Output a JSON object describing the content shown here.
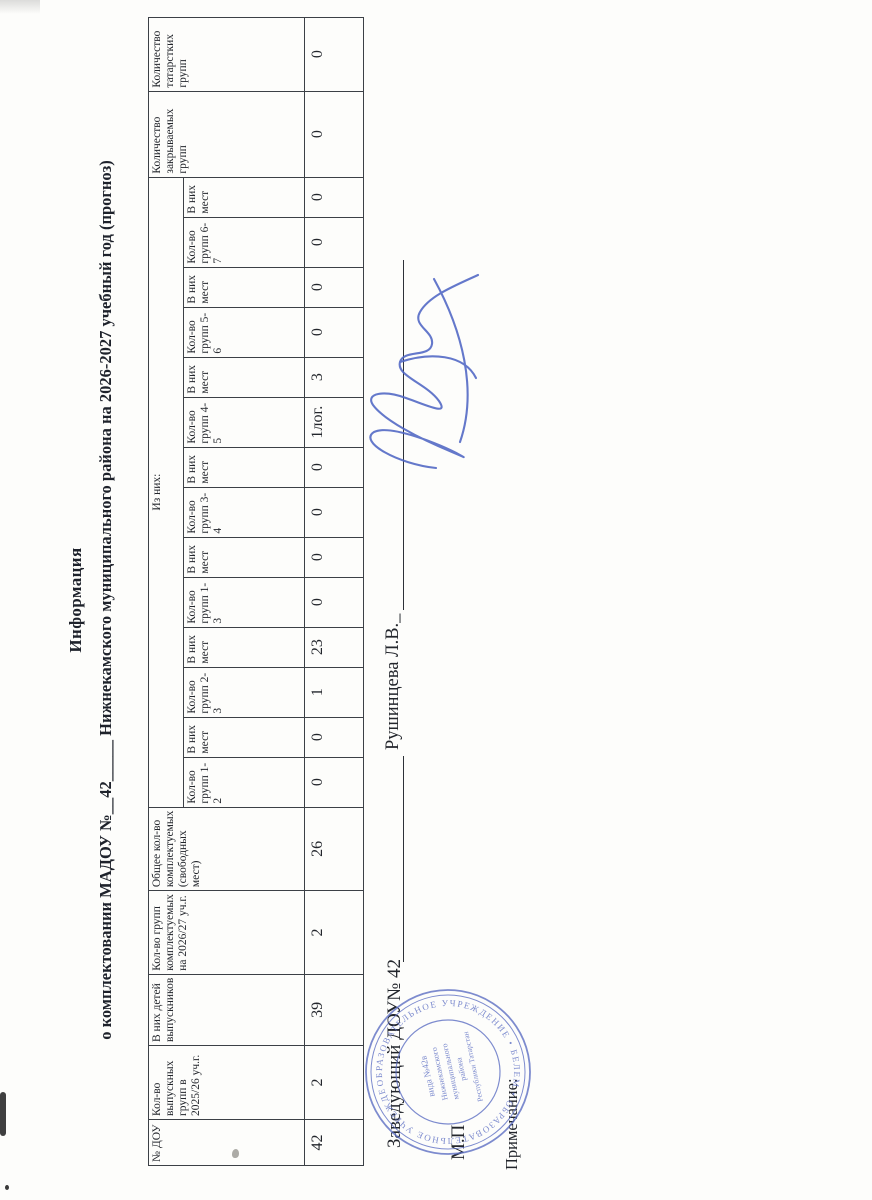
{
  "document": {
    "title_line1": "Информация",
    "title_line2": "о комплектовании МАДОУ №__42_____ Нижнекамского муниципального района на 2026-2027 учебный год (прогноз)"
  },
  "table": {
    "headers": {
      "dou": "№ ДОУ",
      "graduating_groups": "Кол-во выпускных групп в 2025/26 уч.г.",
      "graduating_children": "В них детей выпускников",
      "groups_to_fill": "Кол-во групп комплектуемых на 2026/27 уч.г.",
      "total_free_places": "Общее кол-во комплектуемых (свободных мест)",
      "iz_nih": "Из них:",
      "closing_groups": "Количество закрываемых групп",
      "tatar_groups": "Количество татарстких групп"
    },
    "sub_headers": [
      "Кол-во групп 1-2",
      "В них мест",
      "Кол-во групп 2-3",
      "В них мест",
      "Кол-во групп 1-3",
      "В них мест",
      "Кол-во групп 3-4",
      "В них мест",
      "Кол-во групп 4-5",
      "В них мест",
      "Кол-во групп 5-6",
      "В них мест",
      "Кол-во групп 6-7",
      "В них мест"
    ],
    "values": [
      "42",
      "2",
      "39",
      "2",
      "26",
      "0",
      "0",
      "1",
      "23",
      "0",
      "0",
      "0",
      "0",
      "1лог.",
      "3",
      "0",
      "0",
      "0",
      "0",
      "0",
      "0"
    ]
  },
  "signature": {
    "position_label": "Заведующий ДОУ№ 42",
    "name": "Рушинцева Л.В._",
    "mp": "М.П",
    "note": "Примечание:"
  },
  "seal": {
    "ring_text": "ОБРАЗОВАТЕЛЬНОЕ УЧРЕЖДЕНИЕ • БЕЛЕМ • ОБРАЗОВАТЕЛЬНОЕ УЧРЕЖДЕНИЕ •",
    "center_lines": [
      "вида №42в",
      "Нижнекамского",
      "муниципального",
      "района",
      "Республики Татарстан"
    ]
  },
  "colors": {
    "ink": "#23262c",
    "seal_blue": "#5a6cc2",
    "signature_blue": "#4f66c4",
    "paper": "#fdfdfb"
  }
}
